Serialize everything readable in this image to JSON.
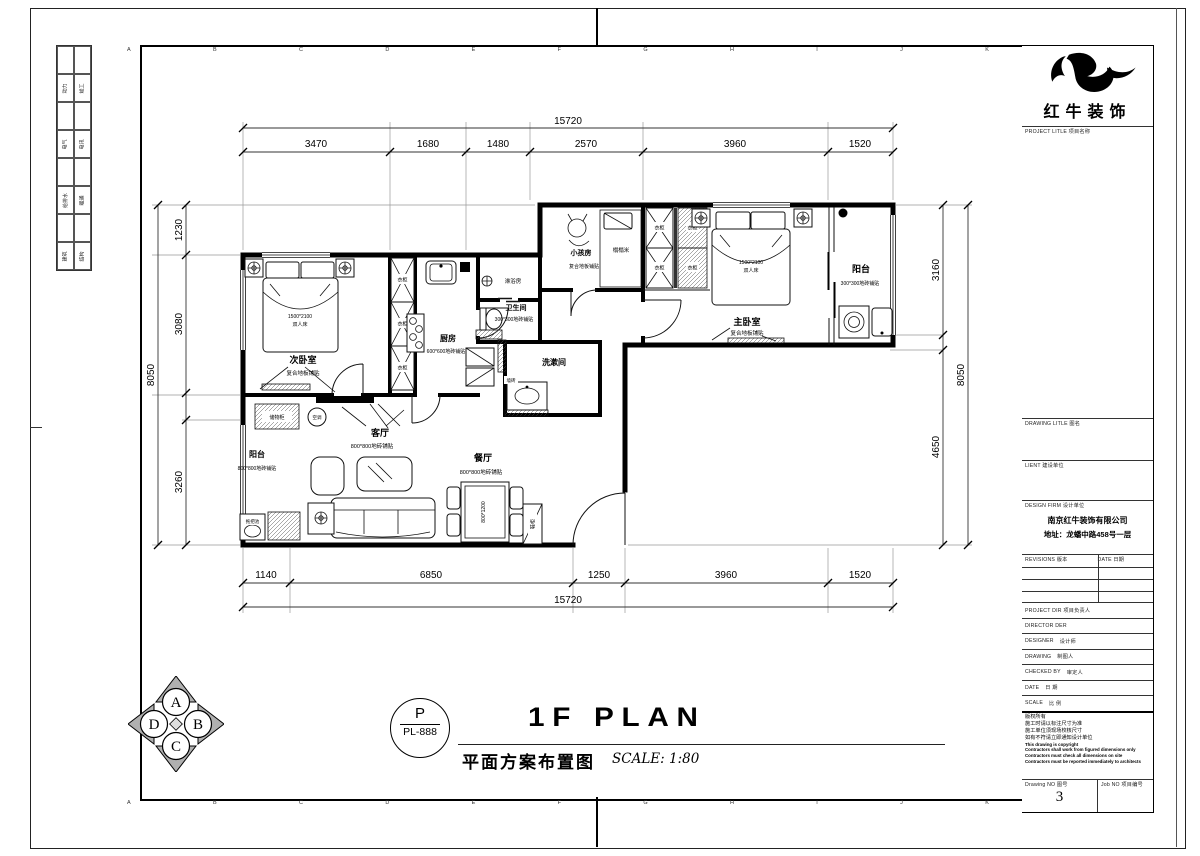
{
  "sheet": {
    "grid_letters": [
      "A",
      "B",
      "C",
      "D",
      "E",
      "F",
      "G",
      "H",
      "I",
      "J",
      "K"
    ],
    "discipline": [
      {
        "l": "动力",
        "r": "竣工"
      },
      {
        "l": "电气",
        "r": "电讯"
      },
      {
        "l": "给排水",
        "r": "暖通"
      },
      {
        "l": "建筑",
        "r": "结构"
      }
    ]
  },
  "plan": {
    "dims": {
      "top_overall": "15720",
      "top": [
        "3470",
        "1680",
        "1480",
        "2570",
        "3960",
        "1520"
      ],
      "bottom": [
        "1140",
        "6850",
        "1250",
        "3960",
        "1520"
      ],
      "bottom_overall": "15720",
      "left": [
        "1230",
        "3080",
        "3260"
      ],
      "left_overall": "8050",
      "right": [
        "3160",
        "4650"
      ],
      "right_overall": "8050"
    },
    "rooms": {
      "ciwo": {
        "name": "次卧室",
        "finish": "复合地板铺贴"
      },
      "chufang": {
        "name": "厨房",
        "finish": "600*600地砖铺贴"
      },
      "linyu": {
        "name": "淋浴房"
      },
      "weisheng": {
        "name": "卫生间",
        "finish": "300*300地砖铺贴"
      },
      "xishu": {
        "name": "洗漱间"
      },
      "xiaohai": {
        "name": "小孩房",
        "finish": "复合地板铺贴"
      },
      "tatami": {
        "name": "榻榻米"
      },
      "zhuwo": {
        "name": "主卧室",
        "finish": "复合地板铺贴"
      },
      "yangtai_ne": {
        "name": "阳台",
        "finish": "300*300地砖铺贴"
      },
      "keting": {
        "name": "客厅",
        "finish": "800*800地砖铺贴"
      },
      "canting": {
        "name": "餐厅",
        "finish": "800*800地砖铺贴"
      },
      "yangtai_sw": {
        "name": "阳台",
        "finish": "800*800地砖铺贴"
      }
    },
    "furniture": {
      "bed_size": "1500*2100",
      "bed_type": "双人床",
      "wardrobe": "衣柜",
      "storage": "储物柜",
      "ac": "空调",
      "shoe": "鞋柜",
      "table_size": "800*1200",
      "wall_tile": "墙砖",
      "mop": "拖把池"
    }
  },
  "title_block": {
    "brand": "红牛装饰",
    "project_label": "PROJECT LITLE  项目名称",
    "drawing_title_label": "DRAWING LITLE  图名",
    "client_label": "LIENT  建设单位",
    "design_firm_label": "DESIGN FIRM  设计单位",
    "firm_name": "南京红牛装饰有限公司",
    "firm_address": "地址：龙蟠中路458号一层",
    "revisions_label": "REVISIONS  版本",
    "date_col_label": "DATE  日期",
    "project_dir_label": "PROJECT DIR  项目负责人",
    "director_label": "DIRECTOR DER",
    "designer_en": "DESIGNER",
    "designer_cn": "设计师",
    "drawing_en": "DRAWING",
    "drawing_cn": "制图人",
    "checked_en": "CHECKED BY",
    "checked_cn": "审定人",
    "date_en": "DATE",
    "date_cn": "日 期",
    "scale_en": "SCALE",
    "scale_cn": "比 例",
    "copyright_cn": [
      "版权所有",
      "施工时请以标注尺寸为准",
      "施工单位须现场校核尺寸",
      "如有不符请立即通知设计单位"
    ],
    "copyright_en": [
      "This drawing is copyright",
      "Contractors shall work from figured dimensions only",
      "Contractors must check all dimensions on site",
      "Contractors must be reported immediately to architects"
    ],
    "drawing_no_label": "Drawing NO  图号",
    "drawing_no": "3",
    "job_no_label": "Job NO  项目编号"
  },
  "footer": {
    "stamp_letter": "P",
    "stamp_code": "PL-888",
    "title_en": "1F PLAN",
    "title_cn": "平面方案布置图",
    "scale": "SCALE:  1:80"
  },
  "compass": {
    "n": "A",
    "e": "B",
    "s": "C",
    "w": "D"
  }
}
